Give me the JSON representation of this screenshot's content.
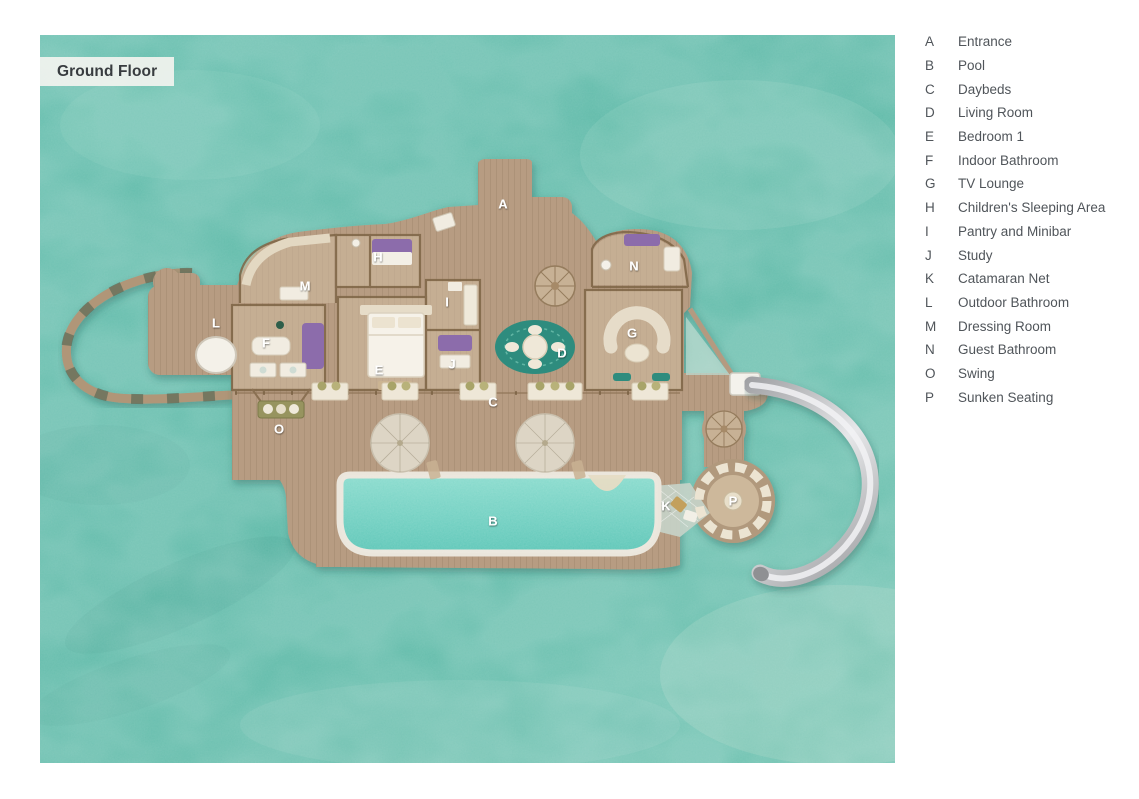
{
  "floor_label": "Ground Floor",
  "colors": {
    "water_base": "#5cbbaa",
    "water_light": "#8ed0bf",
    "deck_wood": "#b79c82",
    "interior_floor": "#d2bda2",
    "wall": "#7e6546",
    "pool_water": "#6fd0c1",
    "pool_rim": "#ebe6dc",
    "slide_silver": "#c9cacc",
    "furniture_purple": "#8c6cab",
    "furniture_cream": "#efe9da",
    "rug_teal": "#2e8c7e",
    "marker_text": "#ffffff",
    "legend_text": "#50555a",
    "label_bg": "#eff2ed"
  },
  "floorplan": {
    "markers": [
      {
        "letter": "A",
        "x": 463,
        "y": 169
      },
      {
        "letter": "B",
        "x": 453,
        "y": 486
      },
      {
        "letter": "C",
        "x": 453,
        "y": 367
      },
      {
        "letter": "D",
        "x": 522,
        "y": 318
      },
      {
        "letter": "E",
        "x": 339,
        "y": 335
      },
      {
        "letter": "F",
        "x": 226,
        "y": 308
      },
      {
        "letter": "G",
        "x": 592,
        "y": 298
      },
      {
        "letter": "H",
        "x": 338,
        "y": 222
      },
      {
        "letter": "I",
        "x": 407,
        "y": 267
      },
      {
        "letter": "J",
        "x": 412,
        "y": 329
      },
      {
        "letter": "K",
        "x": 626,
        "y": 471
      },
      {
        "letter": "L",
        "x": 176,
        "y": 288
      },
      {
        "letter": "M",
        "x": 265,
        "y": 251
      },
      {
        "letter": "N",
        "x": 594,
        "y": 231
      },
      {
        "letter": "O",
        "x": 239,
        "y": 394
      },
      {
        "letter": "P",
        "x": 693,
        "y": 466
      }
    ]
  },
  "legend": {
    "items": [
      {
        "key": "A",
        "label": "Entrance"
      },
      {
        "key": "B",
        "label": "Pool"
      },
      {
        "key": "C",
        "label": "Daybeds"
      },
      {
        "key": "D",
        "label": "Living Room"
      },
      {
        "key": "E",
        "label": "Bedroom 1"
      },
      {
        "key": "F",
        "label": "Indoor Bathroom"
      },
      {
        "key": "G",
        "label": "TV Lounge"
      },
      {
        "key": "H",
        "label": "Children's Sleeping Area"
      },
      {
        "key": "I",
        "label": "Pantry and Minibar"
      },
      {
        "key": "J",
        "label": "Study"
      },
      {
        "key": "K",
        "label": "Catamaran Net"
      },
      {
        "key": "L",
        "label": "Outdoor Bathroom"
      },
      {
        "key": "M",
        "label": "Dressing Room"
      },
      {
        "key": "N",
        "label": "Guest Bathroom"
      },
      {
        "key": "O",
        "label": "Swing"
      },
      {
        "key": "P",
        "label": "Sunken Seating"
      }
    ]
  }
}
